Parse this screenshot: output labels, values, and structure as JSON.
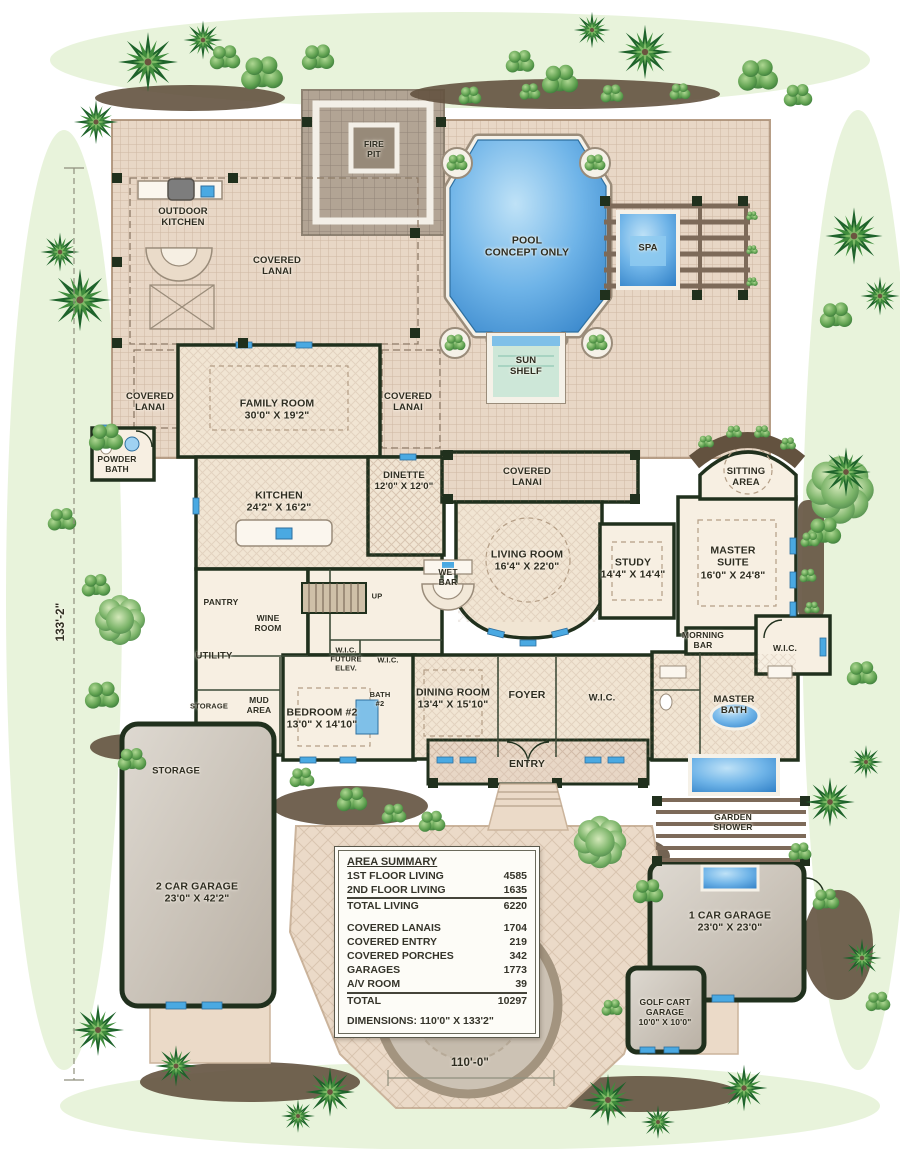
{
  "labels": {
    "fire_pit": "FIRE\nPIT",
    "outdoor_kitchen": "OUTDOOR\nKITCHEN",
    "covered_lanai_top": "COVERED\nLANAI",
    "pool": "POOL\nCONCEPT ONLY",
    "spa": "SPA",
    "sun_shelf": "SUN\nSHELF",
    "covered_lanai_left": "COVERED\nLANAI",
    "family_room": "FAMILY ROOM\n30'0\" X 19'2\"",
    "covered_lanai_right": "COVERED\nLANAI",
    "powder_bath": "POWDER\nBATH",
    "covered_lanai_mid": "COVERED\nLANAI",
    "sitting_area": "SITTING\nAREA",
    "kitchen": "KITCHEN\n24'2\" X 16'2\"",
    "dinette": "DINETTE\n12'0\" X 12'0\"",
    "living_room": "LIVING ROOM\n16'4\" X 22'0\"",
    "study": "STUDY\n14'4\" X 14'4\"",
    "master_suite": "MASTER\nSUITE\n16'0\" X 24'8\"",
    "wet_bar": "WET\nBAR",
    "pantry": "PANTRY",
    "wine_room": "WINE\nROOM",
    "up": "UP",
    "morning_bar": "MORNING\nBAR",
    "wic_right": "W.I.C.",
    "utility": "UTILITY",
    "wic_future_elev": "W.I.C.\nFUTURE\nELEV.",
    "wic_small": "W.I.C.",
    "mud_area": "MUD\nAREA",
    "bath2": "BATH\n#2",
    "bedroom2": "BEDROOM #2\n13'0\" X 14'10\"",
    "dining_room": "DINING ROOM\n13'4\" X 15'10\"",
    "foyer": "FOYER",
    "wic_center": "W.I.C.",
    "master_bath": "MASTER\nBATH",
    "storage_room": "STORAGE",
    "entry": "ENTRY",
    "garden_shower": "GARDEN\nSHOWER",
    "garage_storage": "STORAGE",
    "garage_2car": "2 CAR GARAGE\n23'0\" X 42'2\"",
    "garage_1car": "1 CAR GARAGE\n23'0\" X 23'0\"",
    "golf_cart_garage": "GOLF CART\nGARAGE\n10'0\" X 10'0\"",
    "dim_width": "110'-0\"",
    "dim_height": "133'-2\""
  },
  "area_summary": {
    "title": "AREA SUMMARY",
    "rows": [
      {
        "label": "1ST FLOOR LIVING",
        "value": "4585"
      },
      {
        "label": "2ND FLOOR LIVING",
        "value": "1635"
      },
      {
        "label": "TOTAL LIVING",
        "value": "6220"
      },
      {
        "label": "COVERED LANAIS",
        "value": "1704"
      },
      {
        "label": "COVERED ENTRY",
        "value": "219"
      },
      {
        "label": "COVERED PORCHES",
        "value": "342"
      },
      {
        "label": "GARAGES",
        "value": "1773"
      },
      {
        "label": "A/V ROOM",
        "value": "39"
      },
      {
        "label": "TOTAL",
        "value": "10297"
      }
    ],
    "dimensions": "DIMENSIONS: 110'0\" X 133'2\""
  },
  "colors": {
    "pool_water": "#4f9fdd",
    "deck_paving": "#e8d7c6",
    "walls": "#20301d",
    "garage_floor": "#cfc8bf",
    "landscape_green": "#4f9347",
    "driveway_paver": "#ebdac8",
    "window_blue": "#4aa9e2"
  }
}
